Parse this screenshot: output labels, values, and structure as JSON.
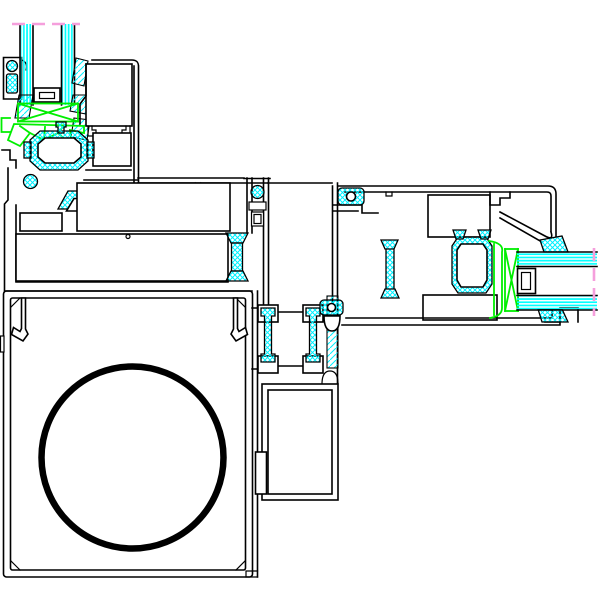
{
  "palette": {
    "background": "#FFFFFF",
    "line": "#000000",
    "thermal_hatch": "#00F0FF",
    "glass": "#00FFFF",
    "gasket": "#00EE00",
    "cutline": "#F59FDC"
  },
  "drawing": {
    "kind": "cad-cross-section",
    "components": [
      {
        "name": "vertical-glazing-unit",
        "fill": "glass-stripes-vertical"
      },
      {
        "name": "glazing-spacer-top",
        "fill": "white"
      },
      {
        "name": "glazing-gasket-top",
        "color": "gasket-green"
      },
      {
        "name": "hinge-clip-left",
        "fill": "thermal-hatch"
      },
      {
        "name": "glazing-bead-profile",
        "fill": "white"
      },
      {
        "name": "thermal-break-octagon-top",
        "fill": "thermal-hatch"
      },
      {
        "name": "sash-bottom-rail",
        "fill": "white"
      },
      {
        "name": "thermal-bridge-bar",
        "fill": "thermal-hatch"
      },
      {
        "name": "thermal-break-s-profile",
        "fill": "thermal-hatch"
      },
      {
        "name": "junction-column",
        "fill": "white"
      },
      {
        "name": "frame-head-right",
        "fill": "white"
      },
      {
        "name": "thermal-break-octagon-right",
        "fill": "thermal-hatch"
      },
      {
        "name": "glazing-gasket-right",
        "color": "gasket-green"
      },
      {
        "name": "horizontal-glazing-unit",
        "fill": "glass-stripes-horizontal"
      },
      {
        "name": "glazing-spacer-right",
        "fill": "white"
      },
      {
        "name": "mullion-vertical",
        "fill": "white"
      },
      {
        "name": "thermal-break-ibeam-left",
        "fill": "thermal-hatch"
      },
      {
        "name": "thermal-break-ibeam-right",
        "fill": "thermal-hatch"
      },
      {
        "name": "bottom-box-profile",
        "fill": "white"
      },
      {
        "name": "circular-tube-bore",
        "stroke": "line-black"
      }
    ]
  },
  "circle": {
    "cx": 132.5,
    "cy": 457.5,
    "r": 91,
    "stroke_width": 6.5
  },
  "cut_lines": {
    "top": {
      "x1": 12,
      "x2": 80,
      "y1": 24,
      "y2": 24
    },
    "right": {
      "x1": 594,
      "x2": 594,
      "y1": 248,
      "y2": 316
    }
  }
}
